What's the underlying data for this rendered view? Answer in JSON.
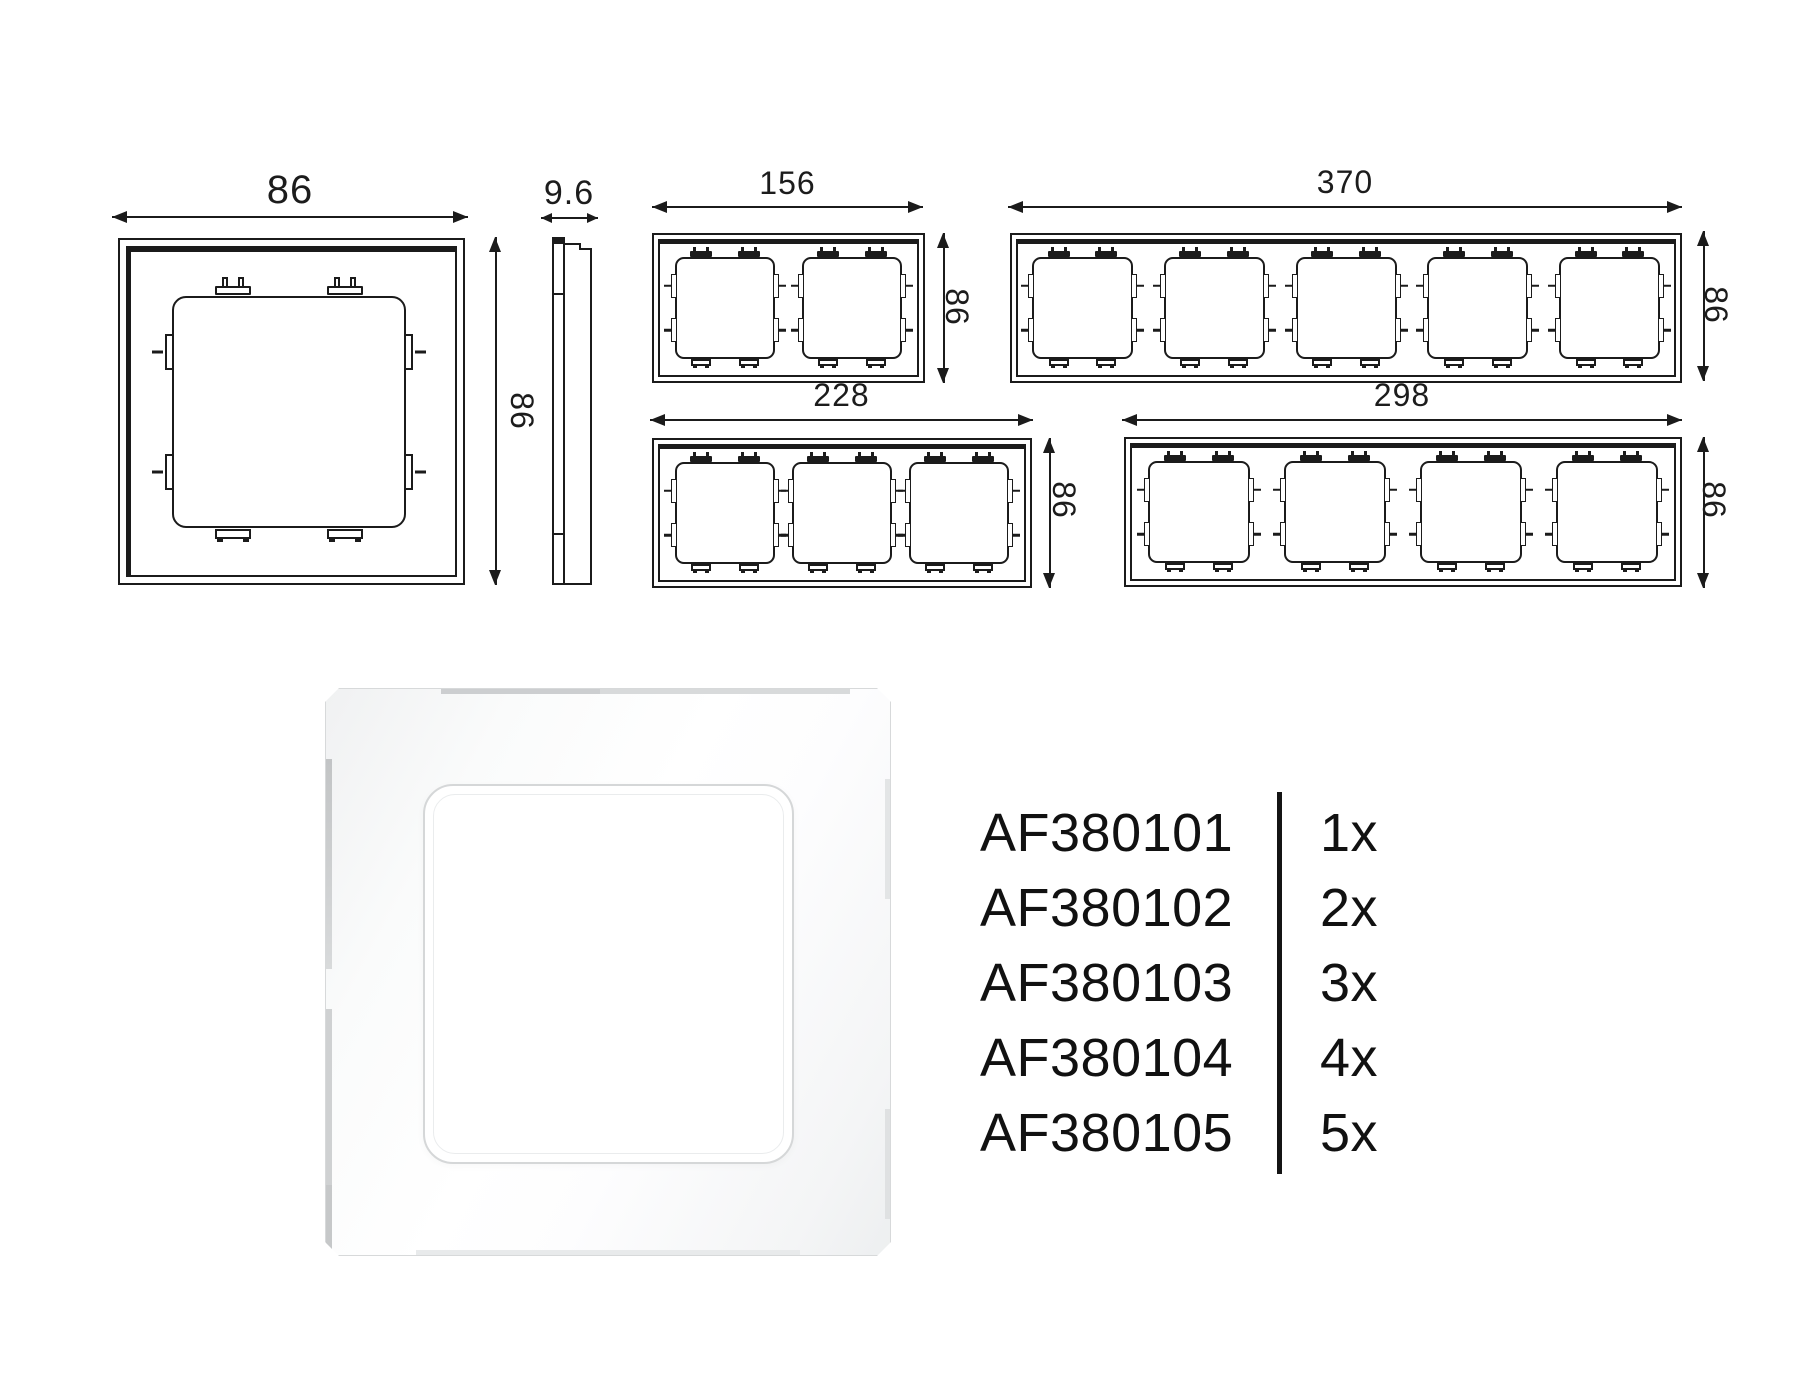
{
  "diagram": {
    "frames": {
      "gang1": {
        "label_width": "86",
        "label_height": "86"
      },
      "profile": {
        "label_depth": "9.6"
      },
      "gang2": {
        "label_width": "156",
        "label_height": "86"
      },
      "gang5": {
        "label_width": "370",
        "label_height": "86"
      },
      "gang3": {
        "label_width": "228",
        "label_height": "86"
      },
      "gang4": {
        "label_width": "298",
        "label_height": "86"
      }
    }
  },
  "product_table": {
    "rows": [
      {
        "code": "AF380101",
        "qty": "1x"
      },
      {
        "code": "AF380102",
        "qty": "2x"
      },
      {
        "code": "AF380103",
        "qty": "3x"
      },
      {
        "code": "AF380104",
        "qty": "4x"
      },
      {
        "code": "AF380105",
        "qty": "5x"
      }
    ]
  },
  "colors": {
    "line": "#1b1b1b",
    "text": "#111111",
    "background": "#ffffff"
  }
}
